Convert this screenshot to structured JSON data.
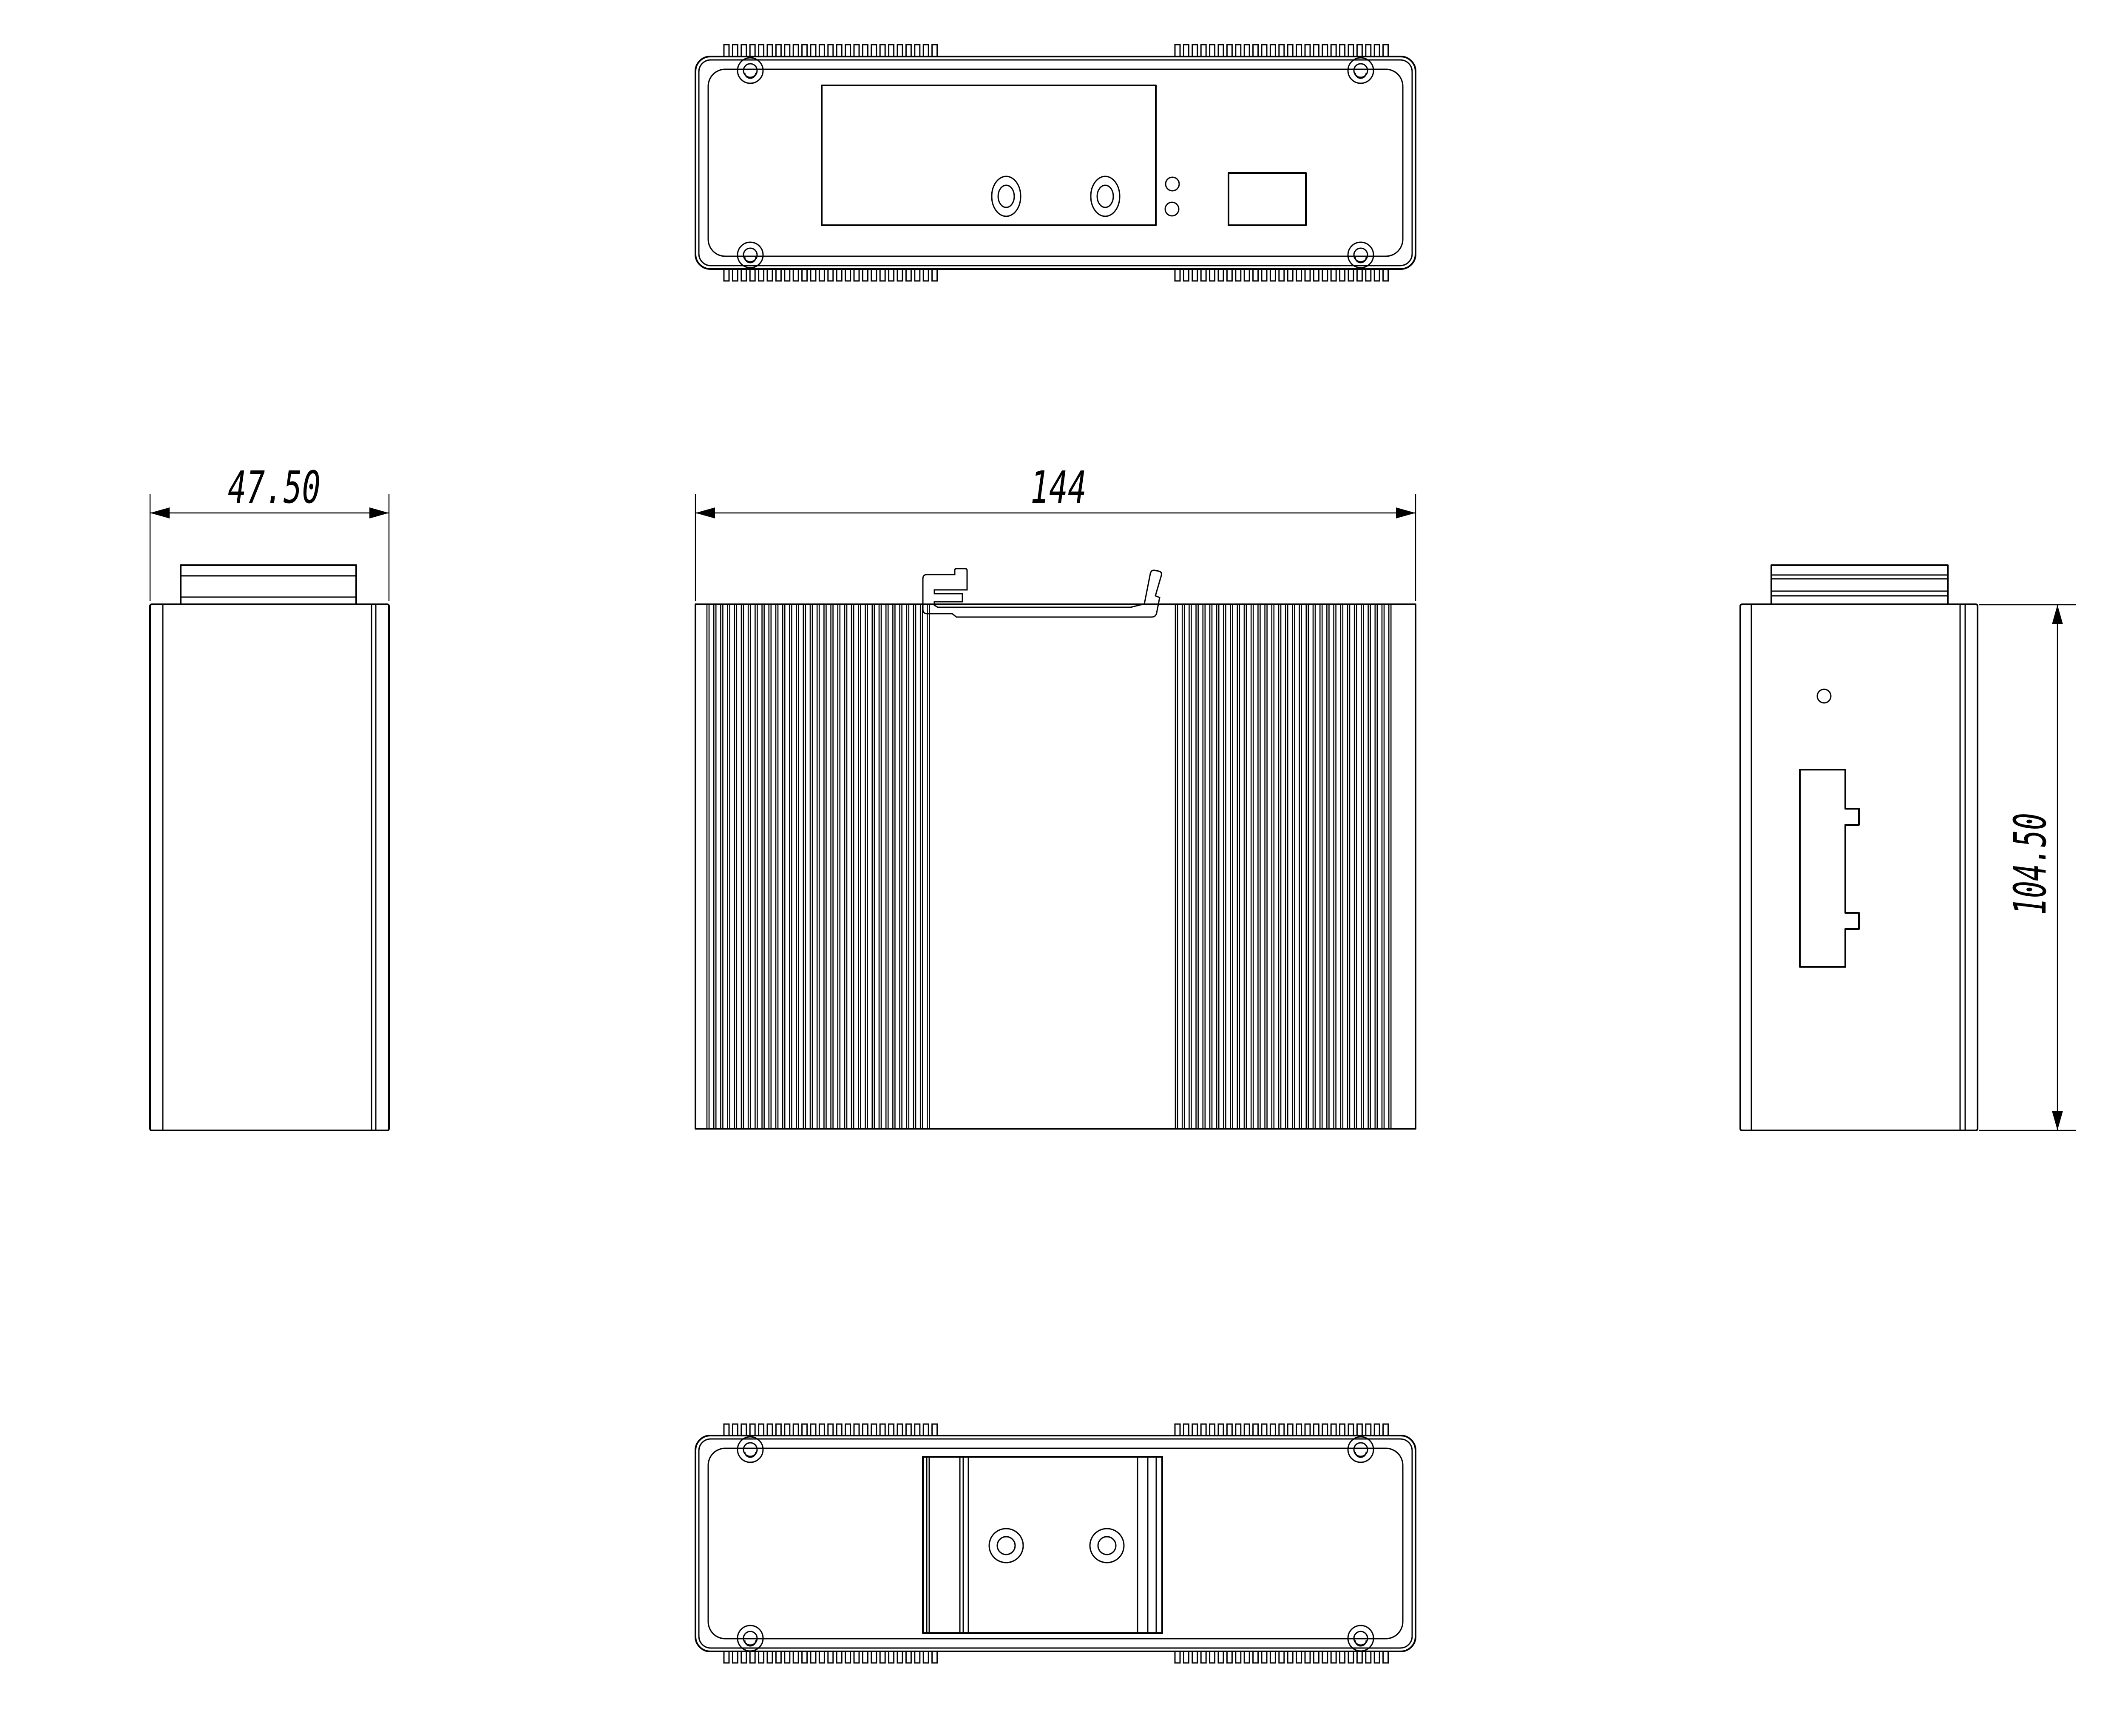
{
  "drawing": {
    "background_color": "#ffffff",
    "line_color": "#000000"
  },
  "dimensions": {
    "width": {
      "label": "144"
    },
    "depth": {
      "label": "47.50"
    },
    "height": {
      "label": "104.50"
    }
  }
}
